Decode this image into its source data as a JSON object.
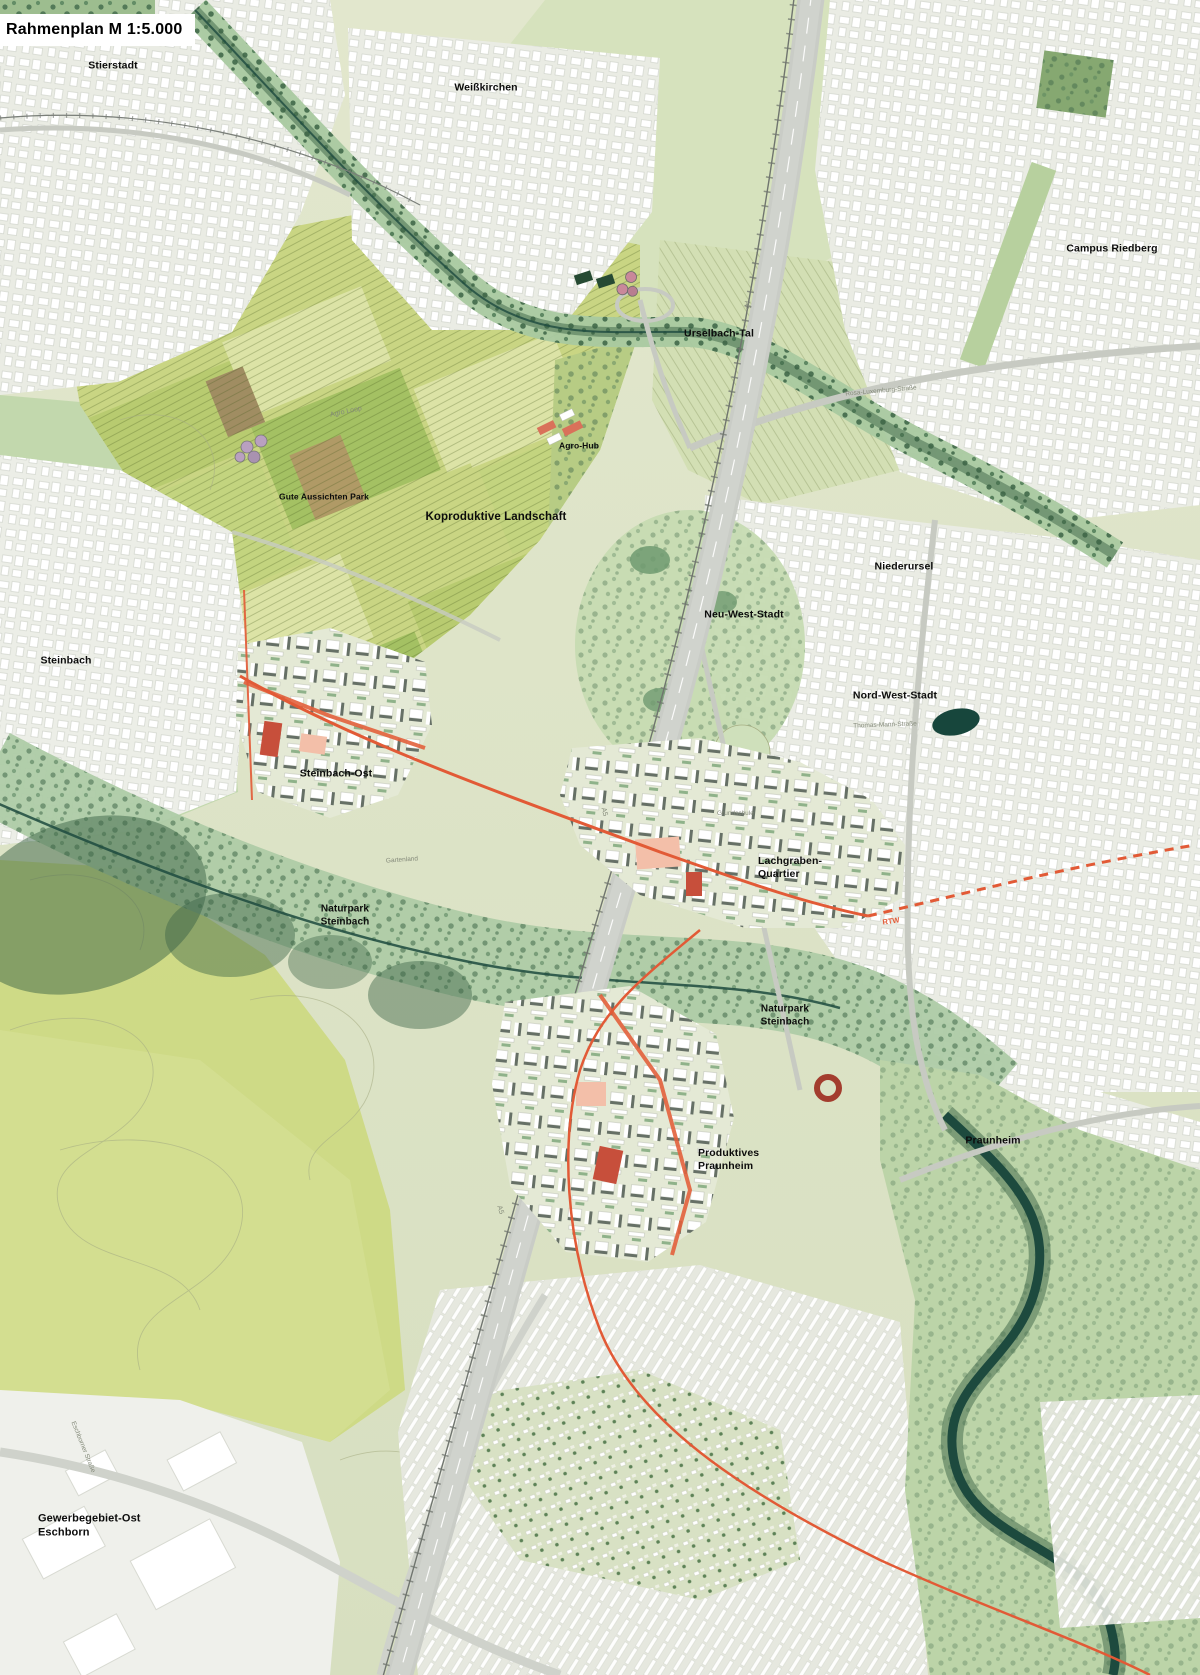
{
  "title": {
    "text": "Rahmenplan M 1:5.000"
  },
  "palette": {
    "base": "#dde3c6",
    "field": "#c9d583",
    "field_light": "#dce3a6",
    "field_mid": "#b8cb70",
    "field_bright": "#a4c163",
    "field_pale": "#d3dfb4",
    "soil": "#b09a66",
    "meadow": "#d6e2bd",
    "park": "#bdd6a8",
    "corridor": "#a9c9a0",
    "tree": "#41694a",
    "forest": "#3b6346",
    "river": "#1d4a3e",
    "water_dark": "#17463c",
    "urban": "#eaece4",
    "road": "#c7cac2",
    "highway": "#d0d3cd",
    "new_base": "#e4e9d5",
    "roof": "#667066",
    "salmon": "#e2603c",
    "salmon_light": "#f3bfa9",
    "red_building": "#c74f3b",
    "accent_route": "#e25a36",
    "contour": "#a6ad83",
    "label": "#0c0c0c",
    "label_muted": "#848a7a"
  },
  "map": {
    "place_labels": [
      {
        "id": "stierstadt",
        "lines": [
          "Stierstadt"
        ],
        "x": 113,
        "y": 66,
        "size": 10.5,
        "anchor": "center"
      },
      {
        "id": "weisskirchen",
        "lines": [
          "Weißkirchen"
        ],
        "x": 486,
        "y": 88,
        "size": 10.5,
        "anchor": "center"
      },
      {
        "id": "campus-riedberg",
        "lines": [
          "Campus Riedberg"
        ],
        "x": 1112,
        "y": 249,
        "size": 10.5,
        "anchor": "center"
      },
      {
        "id": "urselbach-tal",
        "lines": [
          "Urselbach-Tal"
        ],
        "x": 719,
        "y": 334,
        "size": 10.5,
        "anchor": "center"
      },
      {
        "id": "agro-hub",
        "lines": [
          "Agro-Hub"
        ],
        "x": 579,
        "y": 446,
        "size": 8.5,
        "anchor": "center"
      },
      {
        "id": "gute-aussichten-park",
        "lines": [
          "Gute Aussichten Park"
        ],
        "x": 324,
        "y": 497,
        "size": 8.5,
        "anchor": "center"
      },
      {
        "id": "koproduktive-landschaft",
        "lines": [
          "Koproduktive Landschaft"
        ],
        "x": 496,
        "y": 517,
        "size": 11.5,
        "anchor": "center"
      },
      {
        "id": "niederursel",
        "lines": [
          "Niederursel"
        ],
        "x": 904,
        "y": 567,
        "size": 10.5,
        "anchor": "center"
      },
      {
        "id": "neu-west-stadt",
        "lines": [
          "Neu-West-Stadt"
        ],
        "x": 744,
        "y": 615,
        "size": 10.5,
        "anchor": "center"
      },
      {
        "id": "steinbach",
        "lines": [
          "Steinbach"
        ],
        "x": 66,
        "y": 661,
        "size": 10.5,
        "anchor": "center"
      },
      {
        "id": "nord-west-stadt",
        "lines": [
          "Nord-West-Stadt"
        ],
        "x": 895,
        "y": 696,
        "size": 10.5,
        "anchor": "center"
      },
      {
        "id": "steinbach-ost",
        "lines": [
          "Steinbach-Ost"
        ],
        "x": 336,
        "y": 774,
        "size": 10.5,
        "anchor": "center"
      },
      {
        "id": "lachgraben-quartier",
        "lines": [
          "Lachgraben-",
          "Quartier"
        ],
        "x": 758,
        "y": 868,
        "size": 10.5,
        "anchor": "left"
      },
      {
        "id": "naturpark-steinbach-nord",
        "lines": [
          "Naturpark",
          "Steinbach"
        ],
        "x": 345,
        "y": 916,
        "size": 10,
        "anchor": "center"
      },
      {
        "id": "naturpark-steinbach-sued",
        "lines": [
          "Naturpark",
          "Steinbach"
        ],
        "x": 785,
        "y": 1016,
        "size": 10,
        "anchor": "center"
      },
      {
        "id": "praunheim",
        "lines": [
          "Praunheim"
        ],
        "x": 993,
        "y": 1141,
        "size": 10.5,
        "anchor": "center"
      },
      {
        "id": "produktives-praunheim",
        "lines": [
          "Produktives",
          "Praunheim"
        ],
        "x": 698,
        "y": 1160,
        "size": 10.5,
        "anchor": "left"
      },
      {
        "id": "gewerbegebiet-ost-eschborn",
        "lines": [
          "Gewerbegebiet-Ost",
          "Eschborn"
        ],
        "x": 38,
        "y": 1526,
        "size": 11,
        "anchor": "left"
      }
    ],
    "street_labels": [
      {
        "id": "rosa-luxemburg-strasse",
        "text": "Rosa-Luxemburg-Straße",
        "x": 881,
        "y": 391,
        "rot": -5,
        "size": 6.5
      },
      {
        "id": "thomas-mann-strasse",
        "text": "Thomas-Mann-Straße",
        "x": 885,
        "y": 725,
        "rot": -2,
        "size": 6.5
      },
      {
        "id": "agro-loop",
        "text": "Agro Loop",
        "x": 346,
        "y": 412,
        "rot": -12,
        "size": 7
      },
      {
        "id": "eschborner-strasse",
        "text": "Eschborner Straße",
        "x": 83,
        "y": 1447,
        "rot": 68,
        "size": 6.5
      },
      {
        "id": "grundschule",
        "text": "Grundschule",
        "x": 717,
        "y": 810,
        "rot": 0,
        "size": 6.5
      },
      {
        "id": "gartenland",
        "text": "Gartenland",
        "x": 402,
        "y": 860,
        "rot": -4,
        "size": 6.5
      },
      {
        "id": "autobahn-a5-nord",
        "text": "A5",
        "x": 747,
        "y": 305,
        "rot": 80,
        "size": 7
      },
      {
        "id": "autobahn-a5-mitte",
        "text": "A5",
        "x": 604,
        "y": 812,
        "rot": 76,
        "size": 7
      },
      {
        "id": "autobahn-a5-sued",
        "text": "A5",
        "x": 500,
        "y": 1210,
        "rot": 72,
        "size": 7
      }
    ],
    "route_labels": [
      {
        "id": "rtw",
        "text": "RTW",
        "x": 891,
        "y": 921,
        "rot": -8,
        "size": 7.5
      }
    ]
  }
}
